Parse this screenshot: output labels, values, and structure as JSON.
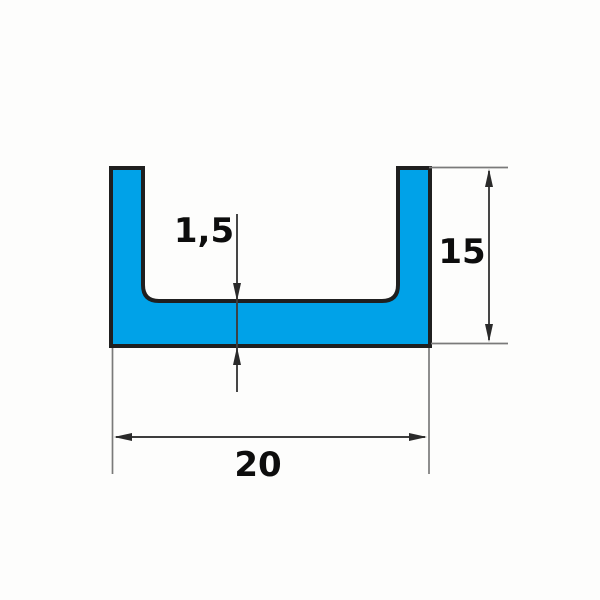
{
  "diagram": {
    "title": "u-channel-profile-cross-section",
    "type": "technical-dimension-drawing",
    "profile": {
      "shape": "U-channel",
      "fill_color": "#00a2e8",
      "outline_color": "#1f1f1f"
    },
    "dimensions": {
      "wall_thickness": {
        "label": "1,5",
        "value": 1.5
      },
      "height": {
        "label": "15",
        "value": 15
      },
      "width": {
        "label": "20",
        "value": 20
      }
    },
    "line_colors": {
      "extension_line": "#7a7a7a",
      "dimension_line": "#3d3d3d"
    }
  }
}
